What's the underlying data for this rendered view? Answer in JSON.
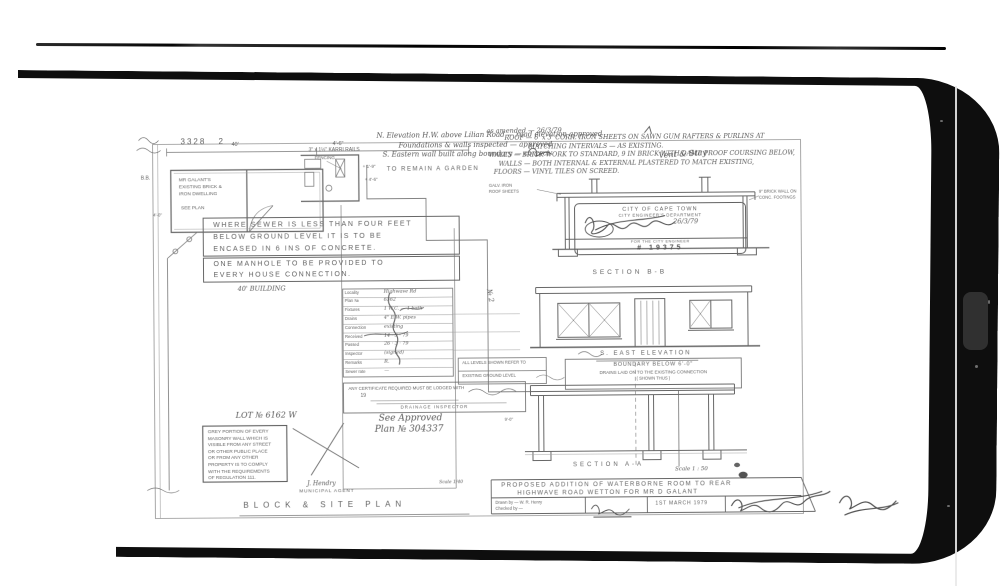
{
  "palette": {
    "paper": "#ffffff",
    "ink": "#4f4f4f",
    "line": "#6e6e6e",
    "frame_black": "#0e0e0e"
  },
  "header": {
    "sheet_no": "3328",
    "sheet_suffix": "2",
    "note1": "N. Elevation H.W. above Lilian Road — road elevation approved",
    "note2": "Foundations & walls inspected — approved",
    "note3": "S. Eastern wall built along boundary — correct",
    "dim_a": "40'",
    "dim_b": "4'-6\"",
    "marker": "B.B.",
    "margin_dim": "4'-0\""
  },
  "plan": {
    "room": [
      "MR GALANT'S",
      "EXISTING BRICK &",
      "IRON DWELLING"
    ],
    "room_note": "SEE PLAN",
    "karri": "3\" x 1½\" KARRI RAILS",
    "karri_sub": "FENCING",
    "dim_small_1": "+ 1'-9\"",
    "dim_small_2": "+ 4'-6\"",
    "garden": "TO REMAIN A GARDEN",
    "lot_marker": "№ 2"
  },
  "notes": {
    "sewer": [
      "WHERE SEWER IS LESS THAN FOUR FEET",
      "BELOW GROUND LEVEL IT IS TO BE",
      "ENCASED IN 6 INS OF CONCRETE."
    ],
    "manhole": [
      "ONE MANHOLE TO BE PROVIDED TO",
      "EVERY HOUSE CONNECTION."
    ],
    "building": "40' BUILDING",
    "lot": "LOT № 6162 W",
    "masonry": [
      "GREY PORTION OF EVERY",
      "MASONRY WALL WHICH IS",
      "VISIBLE FROM ANY STREET",
      "OR OTHER PUBLIC PLACE",
      "OR FROM ANY OTHER",
      "PROPERTY IS TO COMPLY",
      "WITH THE REQUIREMENTS",
      "OF REGULATION 111."
    ],
    "approved1": "See Approved",
    "approved2": "Plan № 304337"
  },
  "form": {
    "rows": [
      {
        "label": "Locality",
        "value": "Highwave Rd"
      },
      {
        "label": "Plan №",
        "value": "6362"
      },
      {
        "label": "Fixtures",
        "value": "1 W.C. — 1 bath"
      },
      {
        "label": "Drains",
        "value": "4\" E.W. pipes"
      },
      {
        "label": "Connection",
        "value": "existing"
      },
      {
        "label": "Received",
        "value": "14 · 3 · 79"
      },
      {
        "label": "Passed",
        "value": "26 · 3 · 79"
      },
      {
        "label": "Inspector",
        "value": "(signed)"
      },
      {
        "label": "Remarks",
        "value": "R."
      },
      {
        "label": "Sewer rate",
        "value": "—"
      }
    ],
    "cert": "ANY CERTIFICATE REQUIRED MUST BE LODGED WITH",
    "cert_year": "19",
    "cert_sign": "DRAINAGE INSPECTOR"
  },
  "spec": {
    "amend": "as amended — 26/3/79",
    "lines": [
      "ROOF — 6' x 3' CORR. IRON SHEETS ON SAWN GUM RAFTERS & PURLINS AT",
      "MATCHING INTERVALS — AS EXISTING.",
      "WALLS — BRICK WORK TO STANDARD, 9 IN BRICK WITH DAMP PROOF COURSING BELOW,",
      "WALLS — BOTH INTERNAL & EXTERNAL PLASTERED TO MATCH EXISTING,",
      "FLOORS — VINYL TILES ON SCREED."
    ],
    "vent": "Vent & Stay",
    "sheet_label1": "GALV. IRON",
    "sheet_label2": "ROOF SHEETS",
    "wall_label1": "9\" BRICK WALL ON",
    "wall_label2": "CONC. FOOTINGS"
  },
  "stamp": {
    "l1": "CITY OF CAPE TOWN",
    "l2": "CITY ENGINEER'S DEPARTMENT",
    "date": "26/3/79",
    "l3": "FOR THE CITY ENGINEER",
    "number": "# 19375"
  },
  "sections": {
    "b": "SECTION B-B",
    "elev": "S. EAST ELEVATION",
    "boundary": [
      "BOUNDARY BELOW 6'-0\"",
      "DRAINS LAID ON TO THE EXISTING CONNECTION",
      "( SHOWN THUS )"
    ],
    "levels": [
      "ALL LEVELS SHOWN REFER TO",
      "EXISTING GROUND LEVEL"
    ],
    "a": "SECTION A-A",
    "a_scale": "Scale 1 : 50",
    "a_dim": "9'-0\""
  },
  "titleblock": {
    "line1": "PROPOSED ADDITION OF WATERBORNE ROOM TO REAR",
    "line2": "HIGHWAVE ROAD WETTON FOR MR D GALANT",
    "drawn": "Drawn by — W. R. Henry",
    "checked": "Checked by —",
    "date": "1ST MARCH 1979"
  },
  "footer": {
    "agent1": "J. Hendry",
    "agent2": "MUNICIPAL AGENT",
    "title": "BLOCK & SITE PLAN",
    "scale": "Scale 1/40"
  }
}
